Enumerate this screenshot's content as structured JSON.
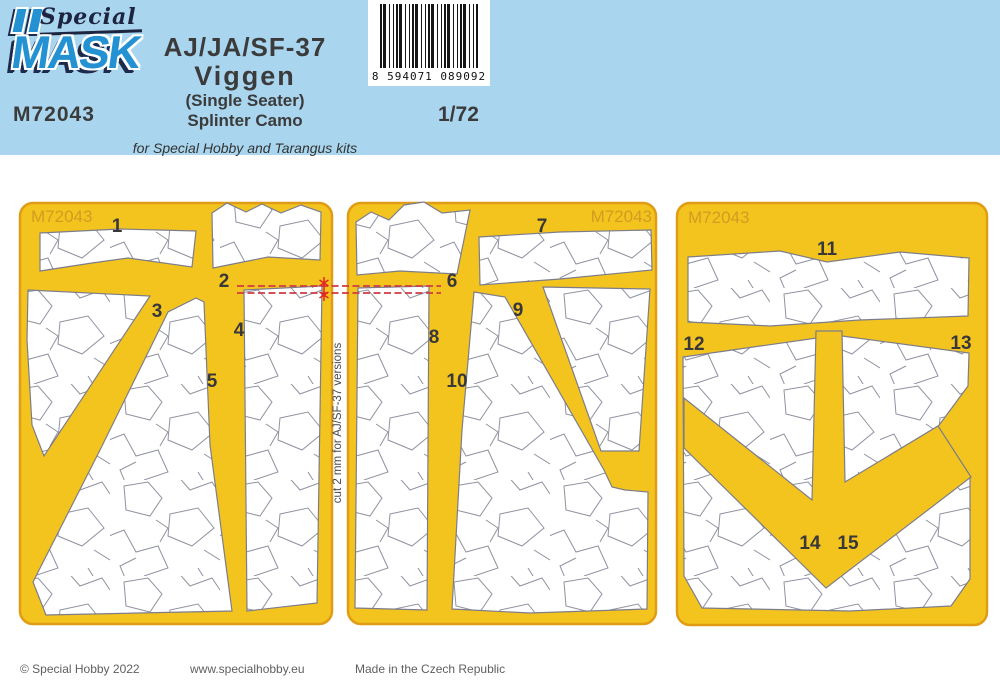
{
  "header": {
    "brand_script": "Special",
    "brand_block": "MASK",
    "product_code": "M72043",
    "title_lines": [
      "AJ/JA/SF-37",
      "Viggen",
      "(Single Seater)",
      "Splinter Camo"
    ],
    "scale": "1/72",
    "subtitle": "for Special Hobby and Tarangus kits",
    "barcode_digits": "8 594071 089092"
  },
  "sheets": [
    {
      "code": "M72043",
      "parts": [
        "1",
        "2",
        "3",
        "4",
        "5"
      ]
    },
    {
      "code": "M72043",
      "parts": [
        "6",
        "7",
        "8",
        "9",
        "10"
      ]
    },
    {
      "code": "M72043",
      "parts": [
        "11",
        "12",
        "13",
        "14",
        "15"
      ]
    }
  ],
  "annotation": {
    "cut_note": "cut 2 mm for AJ/SF-37 versions"
  },
  "footer": {
    "copyright": "© Special Hobby 2022",
    "website": "www.specialhobby.eu",
    "made_in": "Made in the Czech Republic"
  },
  "colors": {
    "header_blue": "#a9d6ee",
    "sheet_yellow": "#f4c41e",
    "sheet_outline": "#e09c15",
    "camo_line": "#8f92a0",
    "brand_blue": "#2492d2",
    "annotation_red": "#cf3a44"
  }
}
